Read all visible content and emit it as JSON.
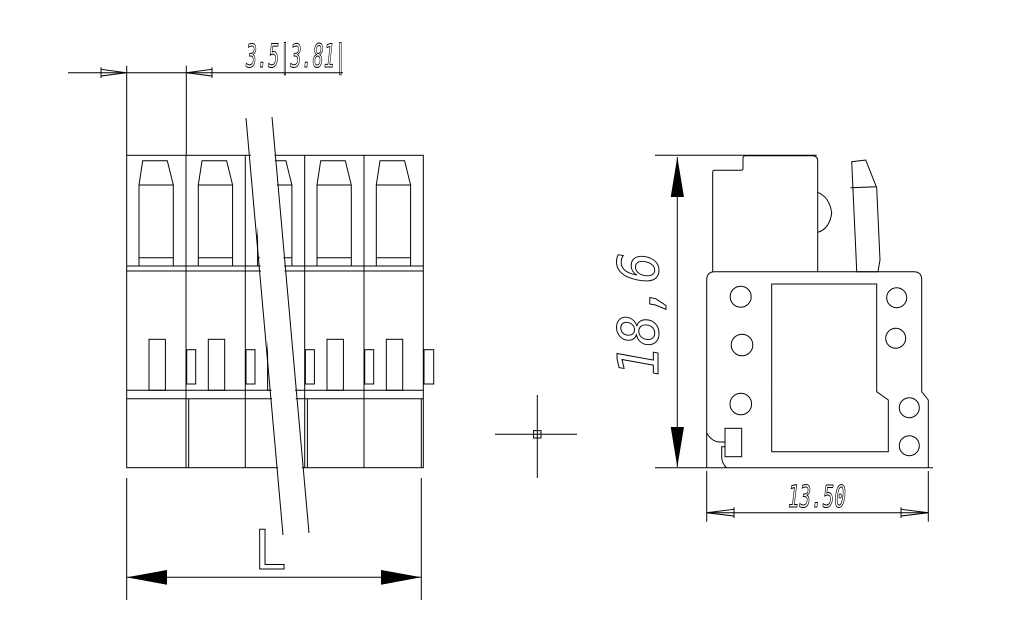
{
  "drawing": {
    "background": "#ffffff",
    "line_color": "#000000",
    "front_view": {
      "poles_visible": 5,
      "dim_pitch": {
        "text": "3.5|3.81|"
      },
      "dim_length": {
        "text": "L"
      }
    },
    "side_view": {
      "dim_height": {
        "text": "18,6"
      },
      "dim_depth": {
        "text": "13.50"
      }
    }
  }
}
